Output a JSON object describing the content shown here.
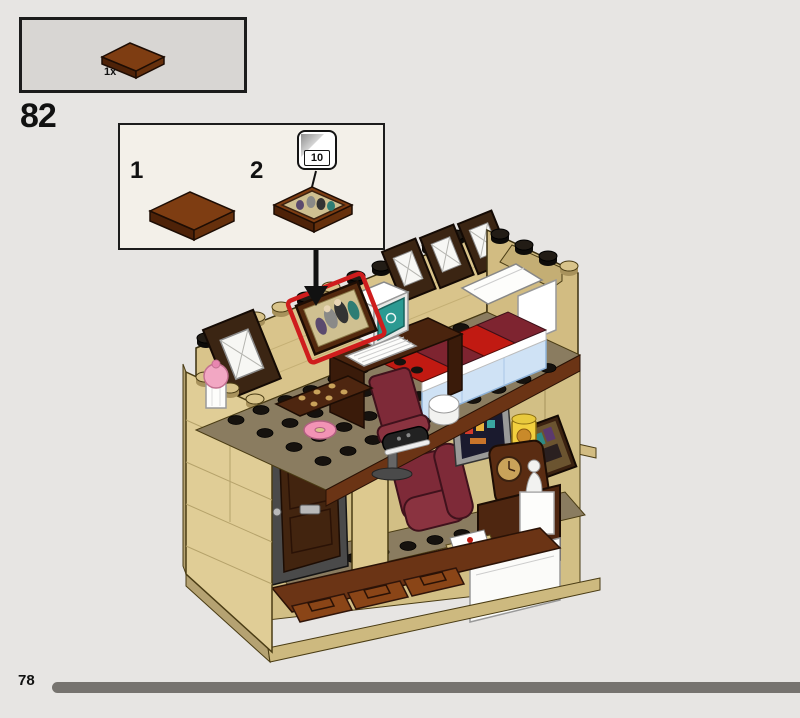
{
  "page": {
    "background": "#e7e5e3",
    "type": "lego-building-instructions"
  },
  "parts_callout": {
    "quantity": "1x",
    "part": "tile-2x3-reddish-brown",
    "part_color": "#7e3d12"
  },
  "step": {
    "number": "82"
  },
  "inset": {
    "substep_1": "1",
    "substep_2": "2",
    "sticker_badge_number": "10",
    "substep_1_part": "tile-2x3-reddish-brown",
    "substep_2_part": "tile-2x3-with-family-photo-sticker"
  },
  "model": {
    "description": "Two-storey house interior cutaway: bedroom with framed photo (highlighted red), computer desk, office chair and red-striped bed above a living room with front door, dark red armchair, TV, jar, mantel clock, statue and envelope",
    "highlight_color": "#cf1d1d",
    "colors": {
      "tan_wall": "#d9c48b",
      "dark_tan_floor": "#8a7c60",
      "dark_brown_window": "#3b2513",
      "reddish_brown": "#7e3d12",
      "dark_red": "#7e2a38",
      "bright_red": "#c11a12",
      "bright_light_blue": "#cfe2f5",
      "teal_screen": "#2b9a92"
    }
  },
  "footer": {
    "page_number": "78",
    "progress_bar_color": "#76736f"
  }
}
